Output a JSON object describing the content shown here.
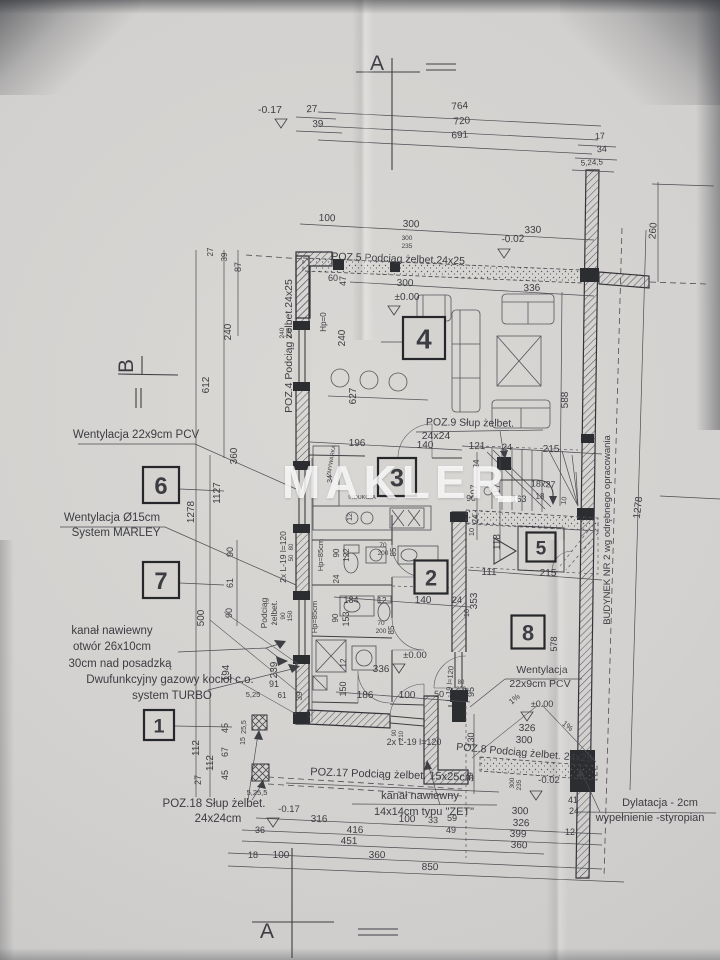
{
  "watermark": "MAKLER",
  "colors": {
    "paper": "#d5d3d0",
    "ink": "#3e3f43",
    "wall_fill": "#2c2d31",
    "watermark": "#ffffff"
  },
  "rooms": [
    {
      "n": "1",
      "x": 159,
      "y": 725,
      "s": 30
    },
    {
      "n": "2",
      "x": 431,
      "y": 577,
      "s": 33
    },
    {
      "n": "3",
      "x": 397,
      "y": 477,
      "s": 38
    },
    {
      "n": "4",
      "x": 424,
      "y": 338,
      "s": 42
    },
    {
      "n": "5",
      "x": 541,
      "y": 547,
      "s": 29
    },
    {
      "n": "6",
      "x": 161,
      "y": 485,
      "s": 36
    },
    {
      "n": "7",
      "x": 161,
      "y": 580,
      "s": 36
    },
    {
      "n": "8",
      "x": 528,
      "y": 632,
      "s": 33
    }
  ],
  "annotations": [
    {
      "t": "Wentylacja 22x9cm PCV",
      "x": 136,
      "y": 438,
      "s": 11.5
    },
    {
      "t": "Wentylacja Ø15cm",
      "x": 112,
      "y": 521,
      "s": 11.5
    },
    {
      "t": "System MARLEY",
      "x": 116,
      "y": 536,
      "s": 11.5
    },
    {
      "t": "kanał nawiewny",
      "x": 112,
      "y": 634,
      "s": 11.5
    },
    {
      "t": "otwór 26x10cm",
      "x": 112,
      "y": 650,
      "s": 11.5
    },
    {
      "t": "30cm nad posadzką",
      "x": 120,
      "y": 667,
      "s": 11.5
    },
    {
      "t": "Dwufunkcyjny gazowy kocioł c.o.",
      "x": 170,
      "y": 683,
      "s": 11.5
    },
    {
      "t": "system TURBO",
      "x": 172,
      "y": 699,
      "s": 11.5
    },
    {
      "t": "POZ.18 Słup żelbet.",
      "x": 214,
      "y": 807,
      "s": 11.5
    },
    {
      "t": "24x24cm",
      "x": 218,
      "y": 822,
      "s": 11.5
    },
    {
      "t": "kanał nawiewny",
      "x": 420,
      "y": 799,
      "s": 11
    },
    {
      "t": "14x14cm typu \"ZET\"",
      "x": 424,
      "y": 815,
      "s": 11
    },
    {
      "t": "POZ.17 Podciąg żelbet.  15x25cm",
      "x": 392,
      "y": 778,
      "s": 11,
      "r": 2
    },
    {
      "t": "POZ.5 Podciąg żelbet.24x25",
      "x": 398,
      "y": 262,
      "s": 10.5,
      "r": 2
    },
    {
      "t": "POZ.4 Podciąg żelbet.24x25",
      "x": 292,
      "y": 346,
      "s": 10.5,
      "r": -90
    },
    {
      "t": "POZ.9 Słup żelbet.",
      "x": 470,
      "y": 426,
      "s": 10.5,
      "r": 1
    },
    {
      "t": "24x24",
      "x": 436,
      "y": 439,
      "s": 10.5
    },
    {
      "t": "POZ.8 Podciąg żelbet.  24x25",
      "x": 524,
      "y": 756,
      "s": 10.5,
      "r": 5
    },
    {
      "t": "Dylatacja - 2cm",
      "x": 660,
      "y": 806,
      "s": 11
    },
    {
      "t": "wypełnienie -styropian",
      "x": 650,
      "y": 821,
      "s": 11
    },
    {
      "t": "BUDYNEK NR 2 wg odrębnego opracowania",
      "x": 610,
      "y": 530,
      "s": 9.5,
      "r": -90
    },
    {
      "t": "Wentylacja",
      "x": 542,
      "y": 673,
      "s": 10.5
    },
    {
      "t": "22x9cm PCV",
      "x": 540,
      "y": 687,
      "s": 10.5
    },
    {
      "t": "A",
      "x": 377,
      "y": 70,
      "s": 21,
      "serif": true
    },
    {
      "t": "A",
      "x": 267,
      "y": 938,
      "s": 21,
      "serif": true
    },
    {
      "t": "B",
      "x": 133,
      "y": 366,
      "s": 21,
      "r": -90,
      "serif": true
    }
  ],
  "dims": [
    {
      "t": "-0.17",
      "x": 270,
      "y": 113,
      "s": 10.5
    },
    {
      "t": "27",
      "x": 312,
      "y": 112,
      "r": -3
    },
    {
      "t": "39",
      "x": 318,
      "y": 127,
      "r": -3
    },
    {
      "t": "764",
      "x": 460,
      "y": 109,
      "r": -4
    },
    {
      "t": "720",
      "x": 462,
      "y": 124,
      "r": -4
    },
    {
      "t": "691",
      "x": 460,
      "y": 138,
      "r": -4
    },
    {
      "t": "17",
      "x": 600,
      "y": 139,
      "r": -3,
      "s": 9
    },
    {
      "t": "34",
      "x": 602,
      "y": 152,
      "r": -3,
      "s": 9
    },
    {
      "t": "5,24,5",
      "x": 592,
      "y": 165,
      "r": -3,
      "s": 8
    },
    {
      "t": "100",
      "x": 327,
      "y": 221,
      "r": 2
    },
    {
      "t": "300",
      "x": 411,
      "y": 227,
      "r": 2
    },
    {
      "t": "330",
      "x": 533,
      "y": 233,
      "r": -2
    },
    {
      "t": "300",
      "x": 407,
      "y": 240,
      "s": 6.5
    },
    {
      "t": "235",
      "x": 407,
      "y": 248,
      "s": 6.5
    },
    {
      "t": "-0.02",
      "x": 513,
      "y": 242,
      "r": -2,
      "s": 10
    },
    {
      "t": "260",
      "x": 656,
      "y": 231,
      "r": -86
    },
    {
      "t": "300",
      "x": 405,
      "y": 286,
      "r": 1
    },
    {
      "t": "336",
      "x": 532,
      "y": 291,
      "r": -2
    },
    {
      "t": "±0.00",
      "x": 407,
      "y": 300,
      "s": 10
    },
    {
      "t": "60",
      "x": 333,
      "y": 281,
      "s": 9
    },
    {
      "t": "47",
      "x": 346,
      "y": 281,
      "r": -90,
      "s": 9
    },
    {
      "t": "240",
      "x": 284,
      "y": 333,
      "r": -90,
      "s": 6.5
    },
    {
      "t": "235",
      "x": 291,
      "y": 333,
      "r": -90,
      "s": 6.5
    },
    {
      "t": "Hp=0",
      "x": 326,
      "y": 322,
      "r": -90,
      "s": 8
    },
    {
      "t": "240",
      "x": 345,
      "y": 338,
      "r": -90
    },
    {
      "t": "627",
      "x": 356,
      "y": 396,
      "r": -90
    },
    {
      "t": "27",
      "x": 213,
      "y": 252,
      "r": -90,
      "s": 8
    },
    {
      "t": "39",
      "x": 227,
      "y": 257,
      "r": -90,
      "s": 8
    },
    {
      "t": "87",
      "x": 241,
      "y": 267,
      "r": -90,
      "s": 9
    },
    {
      "t": "240",
      "x": 231,
      "y": 332,
      "r": -90
    },
    {
      "t": "612",
      "x": 209,
      "y": 385,
      "r": -90
    },
    {
      "t": "360",
      "x": 237,
      "y": 456,
      "r": -90
    },
    {
      "t": "1127",
      "x": 220,
      "y": 493,
      "r": -90
    },
    {
      "t": "1278",
      "x": 194,
      "y": 512,
      "r": -90
    },
    {
      "t": "90",
      "x": 233,
      "y": 552,
      "r": -90,
      "s": 9
    },
    {
      "t": "61",
      "x": 233,
      "y": 583,
      "r": -90,
      "s": 9
    },
    {
      "t": "90",
      "x": 232,
      "y": 613,
      "r": -90,
      "s": 9
    },
    {
      "t": "500",
      "x": 204,
      "y": 618,
      "r": -90
    },
    {
      "t": "194",
      "x": 229,
      "y": 673,
      "r": -90
    },
    {
      "t": "239",
      "x": 277,
      "y": 670,
      "r": -90
    },
    {
      "t": "91",
      "x": 274,
      "y": 687,
      "s": 9
    },
    {
      "t": "5,25",
      "x": 253,
      "y": 697,
      "s": 7.5
    },
    {
      "t": "61",
      "x": 282,
      "y": 698,
      "s": 8
    },
    {
      "t": "39",
      "x": 302,
      "y": 696,
      "r": -90,
      "s": 8
    },
    {
      "t": "112",
      "x": 199,
      "y": 748,
      "r": -90
    },
    {
      "t": "112",
      "x": 213,
      "y": 763,
      "r": -90
    },
    {
      "t": "27",
      "x": 201,
      "y": 780,
      "r": -90,
      "s": 9
    },
    {
      "t": "45",
      "x": 228,
      "y": 728,
      "r": -90,
      "s": 9
    },
    {
      "t": "67",
      "x": 228,
      "y": 752,
      "r": -90,
      "s": 9
    },
    {
      "t": "45",
      "x": 228,
      "y": 775,
      "r": -90,
      "s": 9
    },
    {
      "t": "25,5",
      "x": 246,
      "y": 727,
      "r": -90,
      "s": 7
    },
    {
      "t": "15",
      "x": 245,
      "y": 741,
      "r": -90,
      "s": 7
    },
    {
      "t": "5,25,5",
      "x": 257,
      "y": 795,
      "s": 7.5
    },
    {
      "t": "196",
      "x": 357,
      "y": 446,
      "r": 1
    },
    {
      "t": "140",
      "x": 425,
      "y": 448,
      "r": 1
    },
    {
      "t": "ZMYWARKA",
      "x": 333,
      "y": 461,
      "r": -80,
      "s": 5.5
    },
    {
      "t": "34",
      "x": 332,
      "y": 479,
      "r": -90,
      "s": 7
    },
    {
      "t": "INDUKCJA",
      "x": 362,
      "y": 499,
      "s": 5.5
    },
    {
      "t": "12",
      "x": 352,
      "y": 517,
      "r": -90,
      "s": 7
    },
    {
      "t": "70",
      "x": 383,
      "y": 547,
      "s": 6.5
    },
    {
      "t": "200",
      "x": 383,
      "y": 555,
      "s": 6.5
    },
    {
      "t": "85",
      "x": 396,
      "y": 552,
      "r": -90,
      "s": 8
    },
    {
      "t": "90",
      "x": 339,
      "y": 553,
      "r": -90,
      "s": 8
    },
    {
      "t": "122",
      "x": 349,
      "y": 555,
      "r": -90,
      "s": 8
    },
    {
      "t": "Hp=85cm",
      "x": 323,
      "y": 555,
      "r": -90,
      "s": 7.5
    },
    {
      "t": "24",
      "x": 339,
      "y": 579,
      "r": -90,
      "s": 8
    },
    {
      "t": "184",
      "x": 351,
      "y": 603,
      "s": 9
    },
    {
      "t": "12",
      "x": 382,
      "y": 603,
      "s": 8
    },
    {
      "t": "153",
      "x": 349,
      "y": 619,
      "r": -90,
      "s": 9
    },
    {
      "t": "90",
      "x": 338,
      "y": 618,
      "r": -90,
      "s": 8
    },
    {
      "t": "Hp=85cm",
      "x": 317,
      "y": 617,
      "r": -90,
      "s": 7.5
    },
    {
      "t": "12",
      "x": 346,
      "y": 663,
      "r": -90,
      "s": 8
    },
    {
      "t": "150",
      "x": 346,
      "y": 689,
      "r": -90,
      "s": 9
    },
    {
      "t": "Podciąg",
      "x": 267,
      "y": 613,
      "r": -90,
      "s": 8.5
    },
    {
      "t": "żelbet.",
      "x": 277,
      "y": 613,
      "r": -90,
      "s": 8.5
    },
    {
      "t": "90",
      "x": 285,
      "y": 616,
      "r": -90,
      "s": 6.5
    },
    {
      "t": "150",
      "x": 292,
      "y": 616,
      "r": -90,
      "s": 6.5
    },
    {
      "t": "2x L-19 l=120",
      "x": 286,
      "y": 557,
      "r": -90,
      "s": 8.5
    },
    {
      "t": "80",
      "x": 293,
      "y": 547,
      "r": -90,
      "s": 6
    },
    {
      "t": "50",
      "x": 293,
      "y": 558,
      "r": -90,
      "s": 6
    },
    {
      "t": "70",
      "x": 381,
      "y": 625,
      "s": 6.5
    },
    {
      "t": "200",
      "x": 381,
      "y": 633,
      "s": 6.5
    },
    {
      "t": "85",
      "x": 394,
      "y": 630,
      "r": -90,
      "s": 8
    },
    {
      "t": "±0.00",
      "x": 415,
      "y": 658,
      "s": 9.5
    },
    {
      "t": "336",
      "x": 381,
      "y": 672,
      "r": 1
    },
    {
      "t": "186",
      "x": 365,
      "y": 698,
      "r": 1
    },
    {
      "t": "100",
      "x": 407,
      "y": 698,
      "r": 1
    },
    {
      "t": "50",
      "x": 439,
      "y": 697,
      "r": 1,
      "s": 9
    },
    {
      "t": "90",
      "x": 396,
      "y": 733,
      "r": -90,
      "s": 6
    },
    {
      "t": "210",
      "x": 403,
      "y": 736,
      "r": -90,
      "s": 6
    },
    {
      "t": "2x L-19  l=120",
      "x": 414,
      "y": 745,
      "s": 9
    },
    {
      "t": "L-19 l=120",
      "x": 452,
      "y": 684,
      "r": -85,
      "s": 7.5
    },
    {
      "t": "80",
      "x": 461,
      "y": 684,
      "s": 6
    },
    {
      "t": "200",
      "x": 461,
      "y": 691,
      "s": 6
    },
    {
      "t": "95",
      "x": 474,
      "y": 692,
      "r": -90,
      "s": 9
    },
    {
      "t": "121",
      "x": 477,
      "y": 449,
      "r": 1
    },
    {
      "t": "24",
      "x": 507,
      "y": 450,
      "r": 1,
      "s": 9
    },
    {
      "t": "215",
      "x": 551,
      "y": 452,
      "r": 1
    },
    {
      "t": "24",
      "x": 479,
      "y": 464,
      "r": -90,
      "s": 8
    },
    {
      "t": "107",
      "x": 477,
      "y": 492,
      "r": -90,
      "s": 9
    },
    {
      "t": "117",
      "x": 500,
      "y": 491,
      "r": -90,
      "s": 9
    },
    {
      "t": "90",
      "x": 471,
      "y": 501,
      "s": 8.5
    },
    {
      "t": "163",
      "x": 519,
      "y": 502,
      "s": 9
    },
    {
      "t": "18",
      "x": 540,
      "y": 499,
      "s": 8
    },
    {
      "t": "18x27",
      "x": 543,
      "y": 487,
      "r": 3,
      "s": 9
    },
    {
      "t": "10",
      "x": 566,
      "y": 501,
      "r": -80,
      "s": 7
    },
    {
      "t": "24",
      "x": 478,
      "y": 519,
      "r": -90,
      "s": 8
    },
    {
      "t": "10",
      "x": 474,
      "y": 532,
      "r": -90,
      "s": 7.5
    },
    {
      "t": "118",
      "x": 500,
      "y": 542,
      "r": -90
    },
    {
      "t": "111",
      "x": 489,
      "y": 575,
      "r": 1
    },
    {
      "t": "215",
      "x": 548,
      "y": 576,
      "r": 1
    },
    {
      "t": "353",
      "x": 477,
      "y": 601,
      "r": -90
    },
    {
      "t": "140",
      "x": 423,
      "y": 603,
      "r": 1
    },
    {
      "t": "24",
      "x": 457,
      "y": 603,
      "s": 9
    },
    {
      "t": "10",
      "x": 469,
      "y": 613,
      "r": -90,
      "s": 7.5
    },
    {
      "t": "588",
      "x": 568,
      "y": 400,
      "r": -90
    },
    {
      "t": "578",
      "x": 557,
      "y": 644,
      "r": -90,
      "s": 9
    },
    {
      "t": "1%",
      "x": 516,
      "y": 701,
      "r": -40,
      "s": 8
    },
    {
      "t": "1%",
      "x": 566,
      "y": 728,
      "r": 38,
      "s": 8
    },
    {
      "t": "±0.00",
      "x": 542,
      "y": 707,
      "s": 9
    },
    {
      "t": "326",
      "x": 527,
      "y": 731,
      "r": 2
    },
    {
      "t": "300",
      "x": 524,
      "y": 743,
      "r": 2
    },
    {
      "t": "39",
      "x": 473,
      "y": 777,
      "r": -90,
      "s": 8.5
    },
    {
      "t": "130",
      "x": 474,
      "y": 740,
      "r": -90,
      "s": 9
    },
    {
      "t": "300",
      "x": 514,
      "y": 783,
      "r": -90,
      "s": 6.5
    },
    {
      "t": "235",
      "x": 521,
      "y": 785,
      "r": -90,
      "s": 6.5
    },
    {
      "t": "-0.02",
      "x": 549,
      "y": 783,
      "s": 9.5
    },
    {
      "t": "300",
      "x": 520,
      "y": 814,
      "r": 2
    },
    {
      "t": "326",
      "x": 521,
      "y": 826,
      "r": 2
    },
    {
      "t": "399",
      "x": 518,
      "y": 837,
      "r": 2
    },
    {
      "t": "360",
      "x": 519,
      "y": 848,
      "r": 2
    },
    {
      "t": "41",
      "x": 573,
      "y": 803,
      "s": 9
    },
    {
      "t": "24",
      "x": 574,
      "y": 814,
      "s": 9
    },
    {
      "t": "12",
      "x": 570,
      "y": 835,
      "s": 9
    },
    {
      "t": "-0.17",
      "x": 289,
      "y": 812,
      "s": 9.5
    },
    {
      "t": "316",
      "x": 319,
      "y": 822,
      "r": 1
    },
    {
      "t": "100",
      "x": 407,
      "y": 822,
      "r": 1
    },
    {
      "t": "33",
      "x": 433,
      "y": 823,
      "r": 1,
      "s": 9
    },
    {
      "t": "59",
      "x": 452,
      "y": 821,
      "r": 1,
      "s": 9
    },
    {
      "t": "36",
      "x": 260,
      "y": 833,
      "s": 9
    },
    {
      "t": "416",
      "x": 355,
      "y": 833,
      "r": 1
    },
    {
      "t": "49",
      "x": 451,
      "y": 833,
      "s": 9
    },
    {
      "t": "451",
      "x": 349,
      "y": 844,
      "r": 1
    },
    {
      "t": "18",
      "x": 253,
      "y": 858,
      "s": 9
    },
    {
      "t": "100",
      "x": 281,
      "y": 858
    },
    {
      "t": "360",
      "x": 377,
      "y": 858,
      "r": 1
    },
    {
      "t": "850",
      "x": 430,
      "y": 870,
      "r": 1
    },
    {
      "t": "1278",
      "x": 641,
      "y": 508,
      "r": -83
    }
  ]
}
